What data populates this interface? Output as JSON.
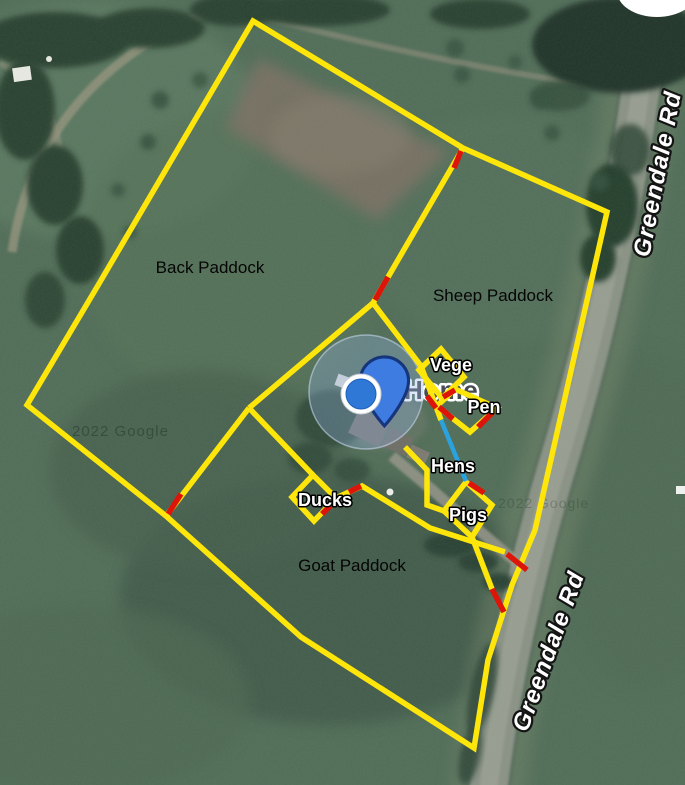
{
  "map": {
    "labels": {
      "place": "Home",
      "paddocks": [
        "Back Paddock",
        "Sheep Paddock",
        "Goat Paddock"
      ],
      "pens": [
        "Vege",
        "Pen",
        "Hens",
        "Ducks",
        "Pigs"
      ],
      "roads": [
        "Greendale Rd",
        "Greendale Rd"
      ],
      "watermarks": [
        "2022 Google",
        "2022 Google"
      ]
    },
    "legend": {
      "boundary_color": "#ffe60a",
      "gate_color": "#dd1408",
      "path_color": "#2aa2df",
      "marker_color": "#3e7ce1",
      "accuracy_circle_color": "rgba(150,180,230,0.32)"
    }
  }
}
